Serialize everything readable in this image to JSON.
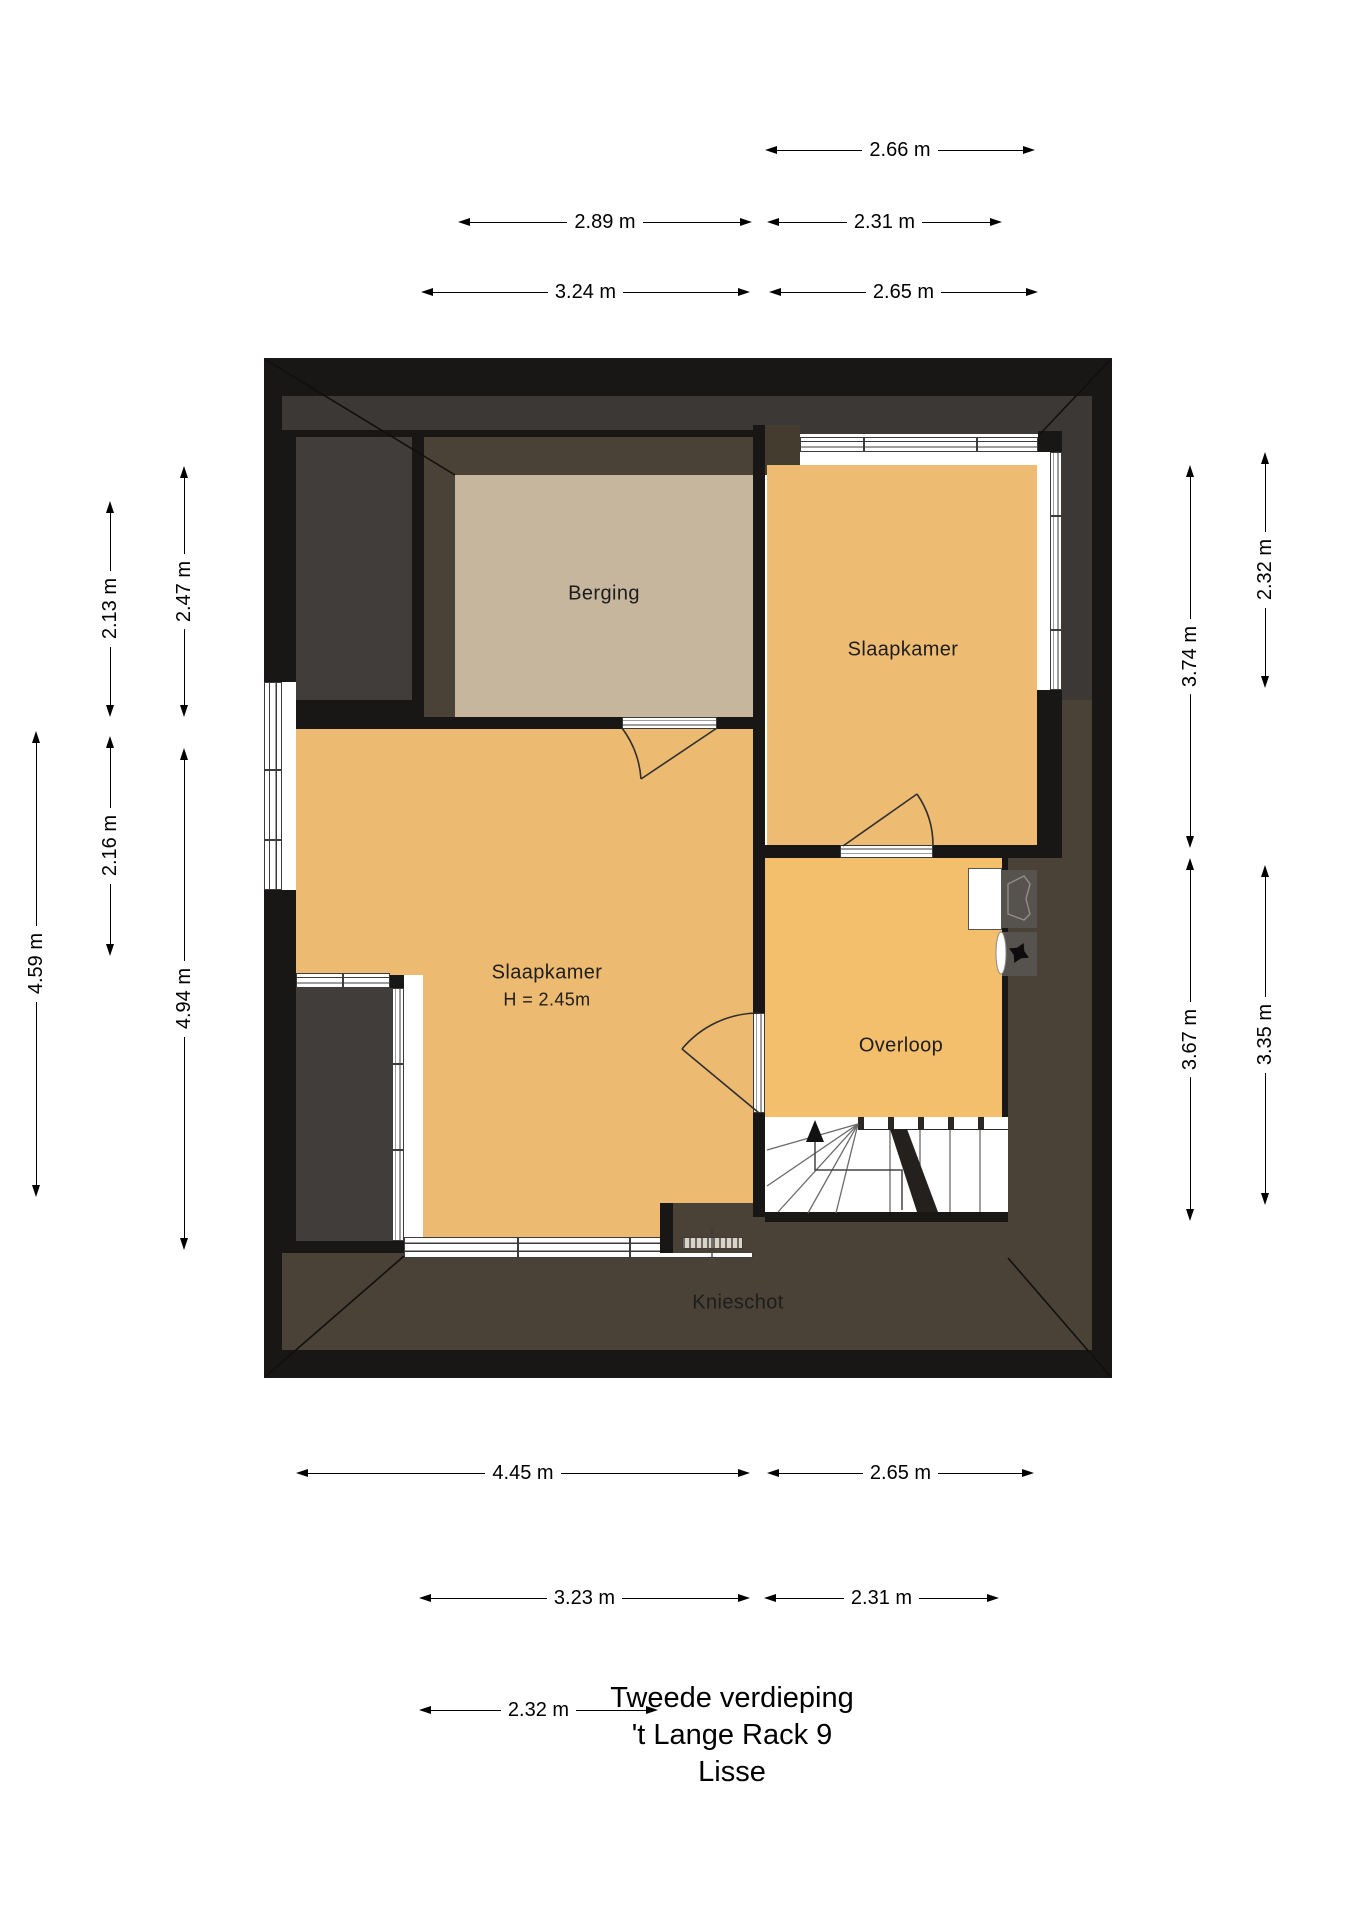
{
  "title": {
    "line1": "Tweede verdieping",
    "line2": "'t Lange Rack 9",
    "line3": "Lisse"
  },
  "rooms": {
    "berging": {
      "label": "Berging"
    },
    "slaapkamer_right": {
      "label": "Slaapkamer"
    },
    "slaapkamer_left": {
      "label": "Slaapkamer",
      "height_note": "H = 2.45m"
    },
    "overloop": {
      "label": "Overloop"
    },
    "knieschot": {
      "label": "Knieschot"
    }
  },
  "dimensions": {
    "horizontal": [
      {
        "label": "2.66 m",
        "x": 765,
        "x2": 1035,
        "y": 150
      },
      {
        "label": "2.89 m",
        "x": 458,
        "x2": 752,
        "y": 222
      },
      {
        "label": "2.31 m",
        "x": 767,
        "x2": 1002,
        "y": 222
      },
      {
        "label": "3.24 m",
        "x": 421,
        "x2": 750,
        "y": 292
      },
      {
        "label": "2.65 m",
        "x": 769,
        "x2": 1038,
        "y": 292
      },
      {
        "label": "4.45 m",
        "x": 296,
        "x2": 750,
        "y": 1473
      },
      {
        "label": "2.65 m",
        "x": 767,
        "x2": 1034,
        "y": 1473
      },
      {
        "label": "3.23 m",
        "x": 419,
        "x2": 750,
        "y": 1598
      },
      {
        "label": "2.31 m",
        "x": 764,
        "x2": 999,
        "y": 1598
      },
      {
        "label": "2.32 m",
        "x": 419,
        "x2": 658,
        "y": 1710
      }
    ],
    "vertical": [
      {
        "label": "4.59 m",
        "x": 36,
        "y": 731,
        "y2": 1197
      },
      {
        "label": "2.13 m",
        "x": 110,
        "y": 501,
        "y2": 717
      },
      {
        "label": "2.16 m",
        "x": 110,
        "y": 736,
        "y2": 956
      },
      {
        "label": "2.47 m",
        "x": 184,
        "y": 466,
        "y2": 717
      },
      {
        "label": "4.94 m",
        "x": 184,
        "y": 748,
        "y2": 1250
      },
      {
        "label": "3.74 m",
        "x": 1190,
        "y": 465,
        "y2": 848
      },
      {
        "label": "3.67 m",
        "x": 1190,
        "y": 858,
        "y2": 1221
      },
      {
        "label": "2.32 m",
        "x": 1265,
        "y": 452,
        "y2": 688
      },
      {
        "label": "3.35 m",
        "x": 1265,
        "y": 865,
        "y2": 1205
      }
    ]
  },
  "fixtures": {
    "stairs": "stairs-up-with-winders",
    "washer_unit": "mechanical-ventilation-boiler-units",
    "doors": [
      "berging-door",
      "slaapkamer-right-door",
      "overloop-slaapkamer-door"
    ]
  },
  "colors": {
    "wall": "#191715",
    "roof_slope": "#3b3835",
    "gray_room": "#413d3a",
    "knieschot_band": "#4a4236",
    "berging_floor": "#c6b69d",
    "bedroom_floor": "#ecba70",
    "overloop_floor": "#f3bf6c",
    "background": "#ffffff"
  }
}
